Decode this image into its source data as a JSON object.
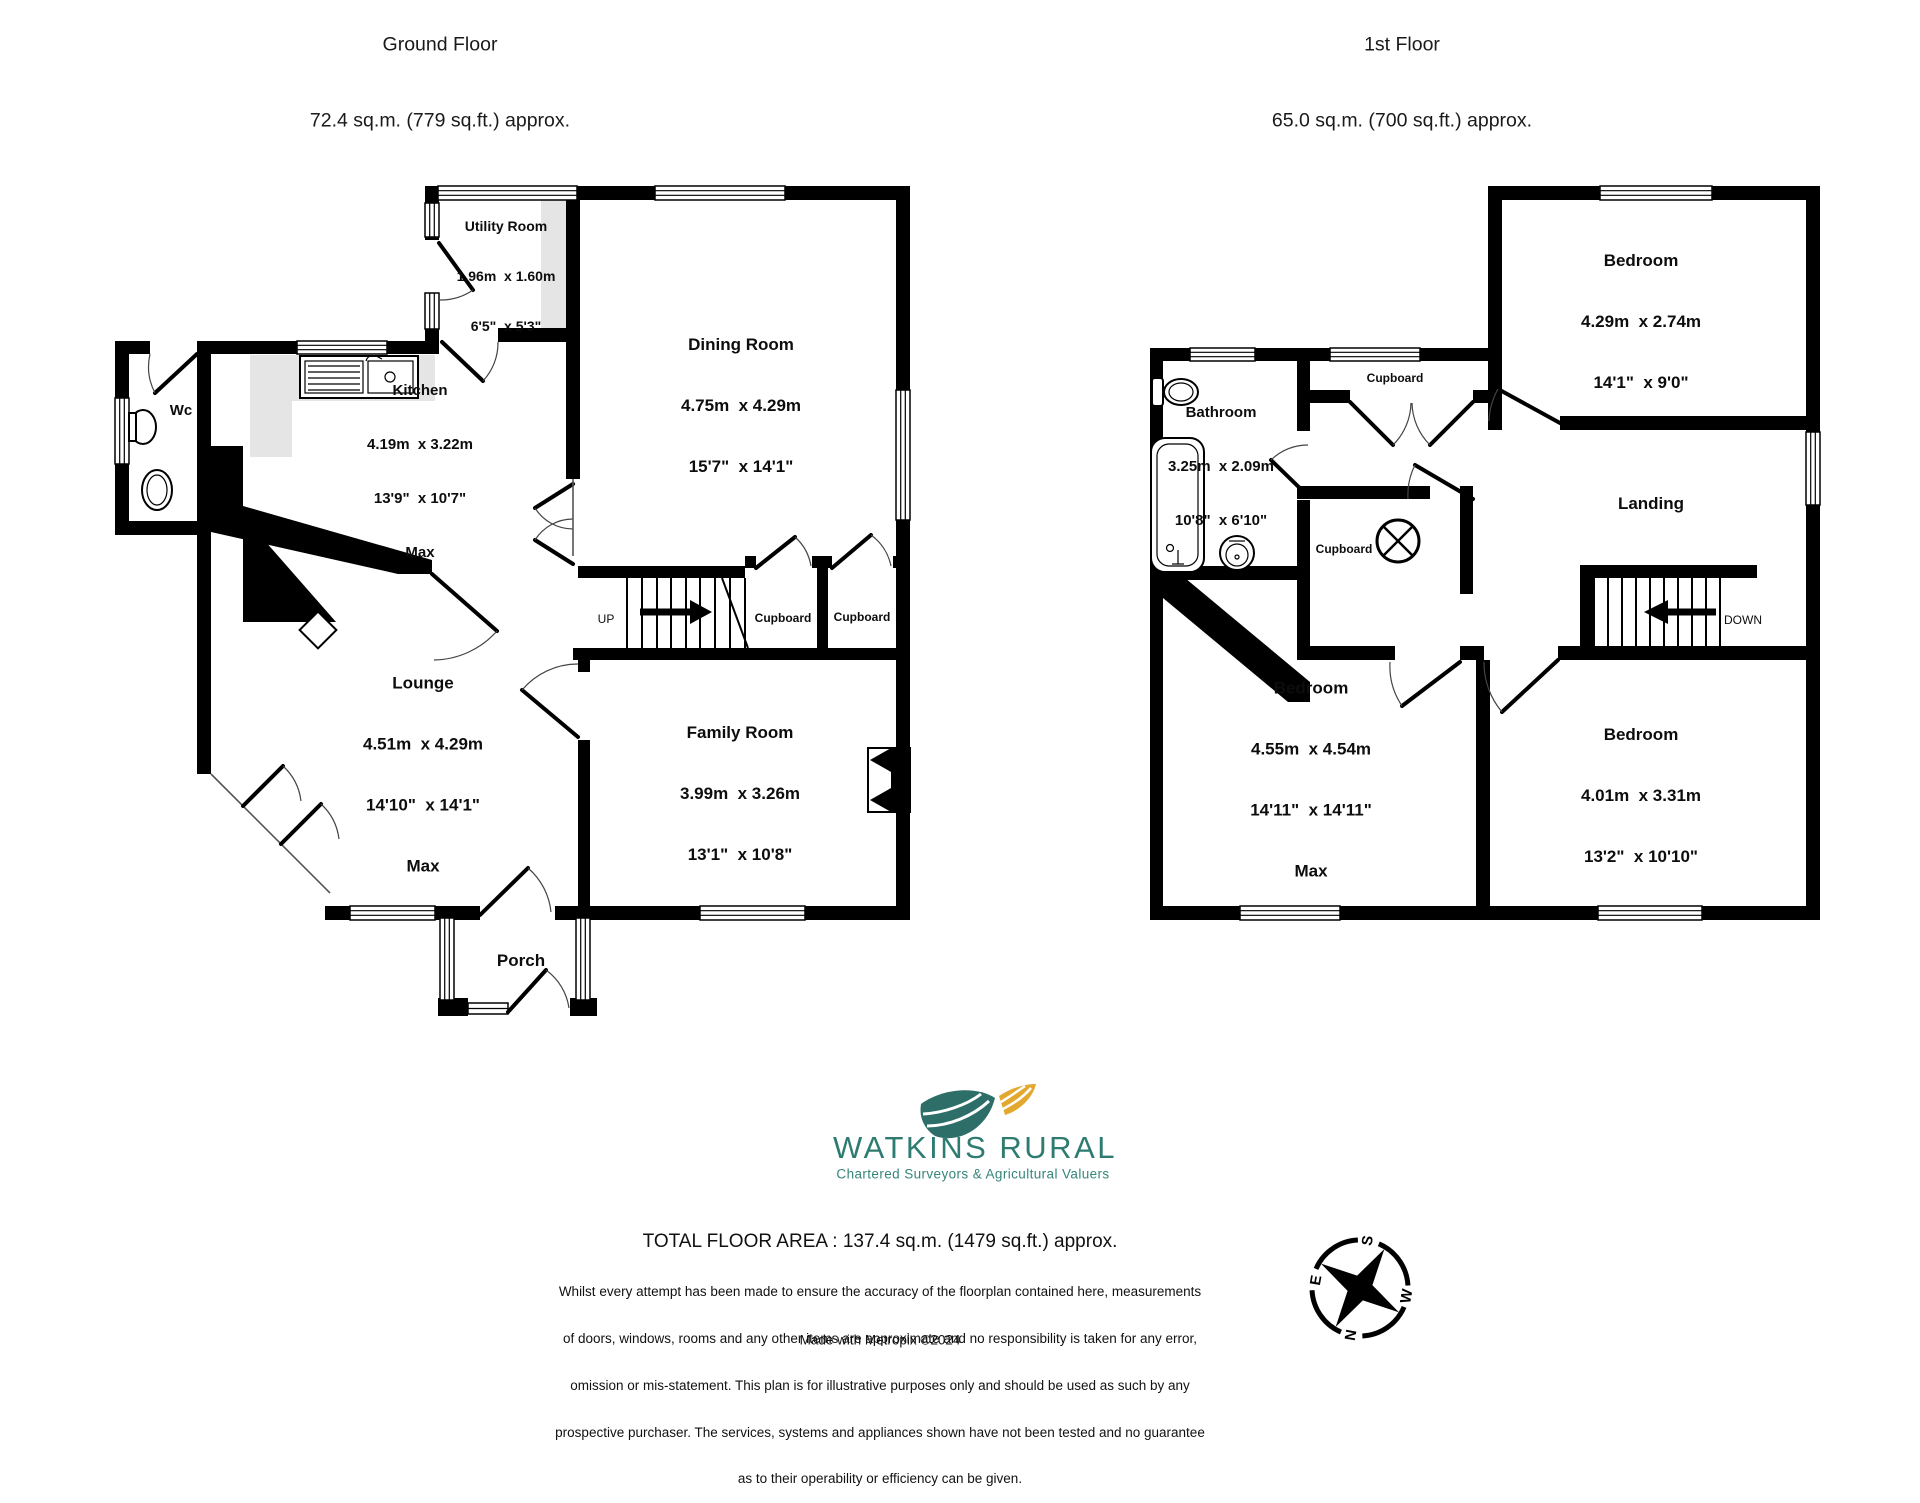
{
  "ground_floor": {
    "title": "Ground Floor",
    "area": "72.4 sq.m. (779 sq.ft.) approx.",
    "stairs_label": "UP",
    "rooms": {
      "utility": {
        "name": "Utility Room",
        "metric": "1.96m  x 1.60m",
        "imperial": "6'5\"  x 5'3\""
      },
      "dining": {
        "name": "Dining Room",
        "metric": "4.75m  x 4.29m",
        "imperial": "15'7\"  x 14'1\""
      },
      "kitchen": {
        "name": "Kitchen",
        "metric": "4.19m  x 3.22m",
        "imperial": "13'9\"  x 10'7\"",
        "note": "Max"
      },
      "wc": {
        "name": "Wc"
      },
      "lounge": {
        "name": "Lounge",
        "metric": "4.51m  x 4.29m",
        "imperial": "14'10\"  x 14'1\"",
        "note": "Max"
      },
      "family": {
        "name": "Family Room",
        "metric": "3.99m  x 3.26m",
        "imperial": "13'1\"  x 10'8\""
      },
      "porch": {
        "name": "Porch"
      },
      "cupboard_a": {
        "name": "Cupboard"
      },
      "cupboard_b": {
        "name": "Cupboard"
      }
    }
  },
  "first_floor": {
    "title": "1st Floor",
    "area": "65.0 sq.m. (700 sq.ft.) approx.",
    "stairs_label": "DOWN",
    "rooms": {
      "bedroom_top": {
        "name": "Bedroom",
        "metric": "4.29m  x 2.74m",
        "imperial": "14'1\"  x 9'0\""
      },
      "bathroom": {
        "name": "Bathroom",
        "metric": "3.25m  x 2.09m",
        "imperial": "10'8\"  x 6'10\""
      },
      "landing": {
        "name": "Landing"
      },
      "cupboard_a": {
        "name": "Cupboard"
      },
      "cupboard_b": {
        "name": "Cupboard"
      },
      "bedroom_left": {
        "name": "Bedroom",
        "metric": "4.55m  x 4.54m",
        "imperial": "14'11\"  x 14'11\"",
        "note": "Max"
      },
      "bedroom_right": {
        "name": "Bedroom",
        "metric": "4.01m  x 3.31m",
        "imperial": "13'2\"  x 10'10\""
      }
    }
  },
  "branding": {
    "company": "WATKINS RURAL",
    "tagline": "Chartered Surveyors & Agricultural Valuers",
    "brand_color": "#2e7b71",
    "accent_color": "#e2a92e"
  },
  "footer": {
    "total": "TOTAL FLOOR AREA : 137.4 sq.m. (1479 sq.ft.) approx.",
    "disclaimer": [
      "Whilst every attempt has been made to ensure the accuracy of the floorplan contained here, measurements",
      "of doors, windows, rooms and any other items are approximate and no responsibility is taken for any error,",
      "omission or mis-statement. This plan is for illustrative purposes only and should be used as such by any",
      "prospective purchaser. The services, systems and appliances shown have not been tested and no guarantee",
      "as to their operability or efficiency can be given."
    ],
    "credit": "Made with Metropix ©2024"
  },
  "compass": {
    "north": "N",
    "east": "E",
    "south": "S",
    "west": "W"
  }
}
